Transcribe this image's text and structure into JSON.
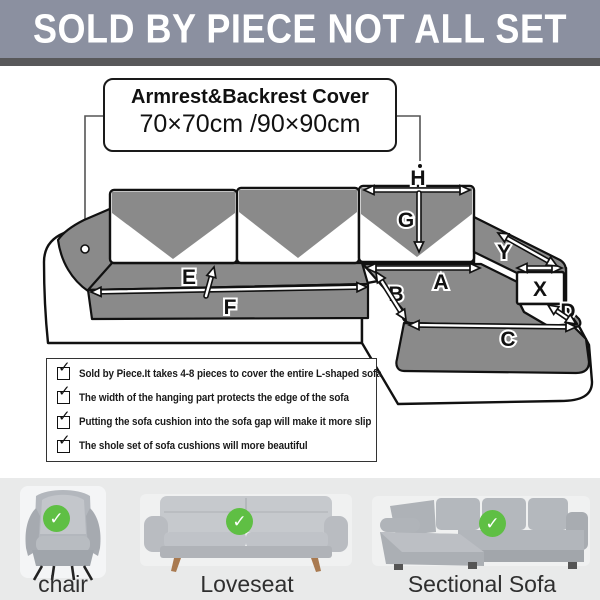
{
  "banner": {
    "text": "SOLD BY PIECE NOT ALL SET"
  },
  "label_box": {
    "title": "Armrest&Backrest Cover",
    "size": "70×70cm /90×90cm"
  },
  "diagram": {
    "labels": {
      "A": "A",
      "B": "B",
      "C": "C",
      "D": "D",
      "E": "E",
      "F": "F",
      "G": "G",
      "H": "H",
      "X": "X",
      "Y": "Y"
    }
  },
  "checklist": {
    "items": [
      "Sold by Piece.It takes 4-8 pieces to cover the entire L-shaped sofa",
      "The width of the hanging part protects the edge of the sofa",
      "Putting the sofa cushion into the sofa gap will make it more slip",
      "The shole set of sofa cushions will more beautiful"
    ]
  },
  "products": [
    {
      "label": "chair"
    },
    {
      "label": "Loveseat"
    },
    {
      "label": "Sectional Sofa"
    }
  ],
  "icons": {
    "check": "✓"
  },
  "colors": {
    "banner_bg": "#8b90a0",
    "banner_stripe": "#58585a",
    "banner_text": "#ffffff",
    "diagram_gray": "#8a8a8a",
    "outline": "#111111",
    "check_green": "#5fbf44",
    "bottom_bg": "#e9eaea",
    "label_text": "#2f2f2f"
  }
}
